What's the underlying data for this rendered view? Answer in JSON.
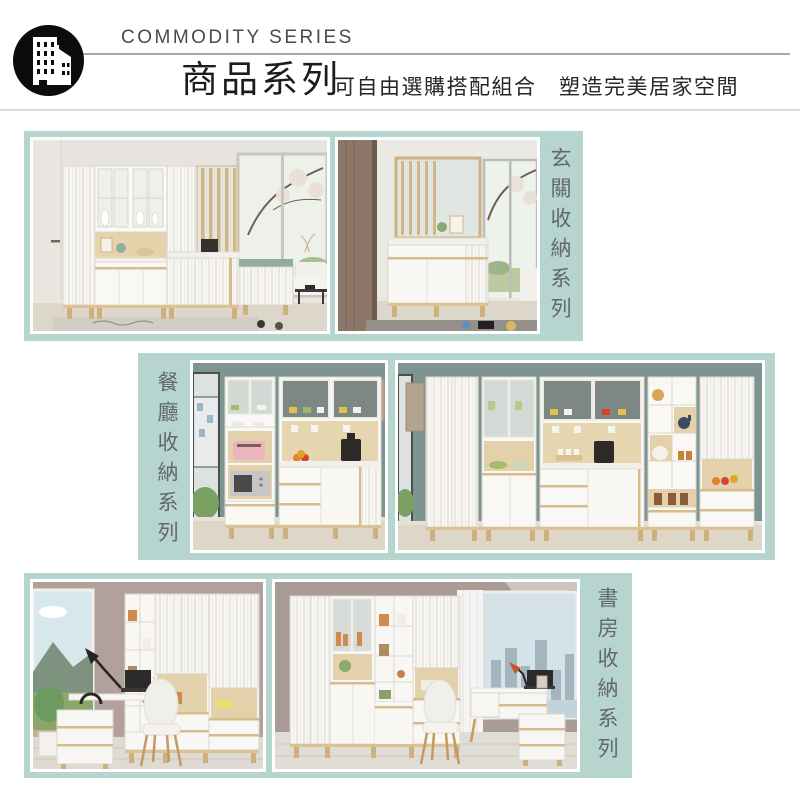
{
  "header": {
    "logo_icon": "building-logo",
    "series_en": "COMMODITY SERIES",
    "series_zh": "商品系列",
    "tagline": "可自由選購搭配組合　塑造完美居家空間"
  },
  "sections": [
    {
      "key": "entryway",
      "title": "玄關收納系列"
    },
    {
      "key": "dining",
      "title": "餐廳收納系列"
    },
    {
      "key": "study",
      "title": "書房收納系列"
    }
  ],
  "colors": {
    "panel_teal": "#b7d5cf",
    "section_title_text": "#63686a",
    "header_rule": "#a8a8a8",
    "header_divider": "#dadada",
    "title_text": "#1c1c1c",
    "series_en_text": "#4a4a4a"
  }
}
